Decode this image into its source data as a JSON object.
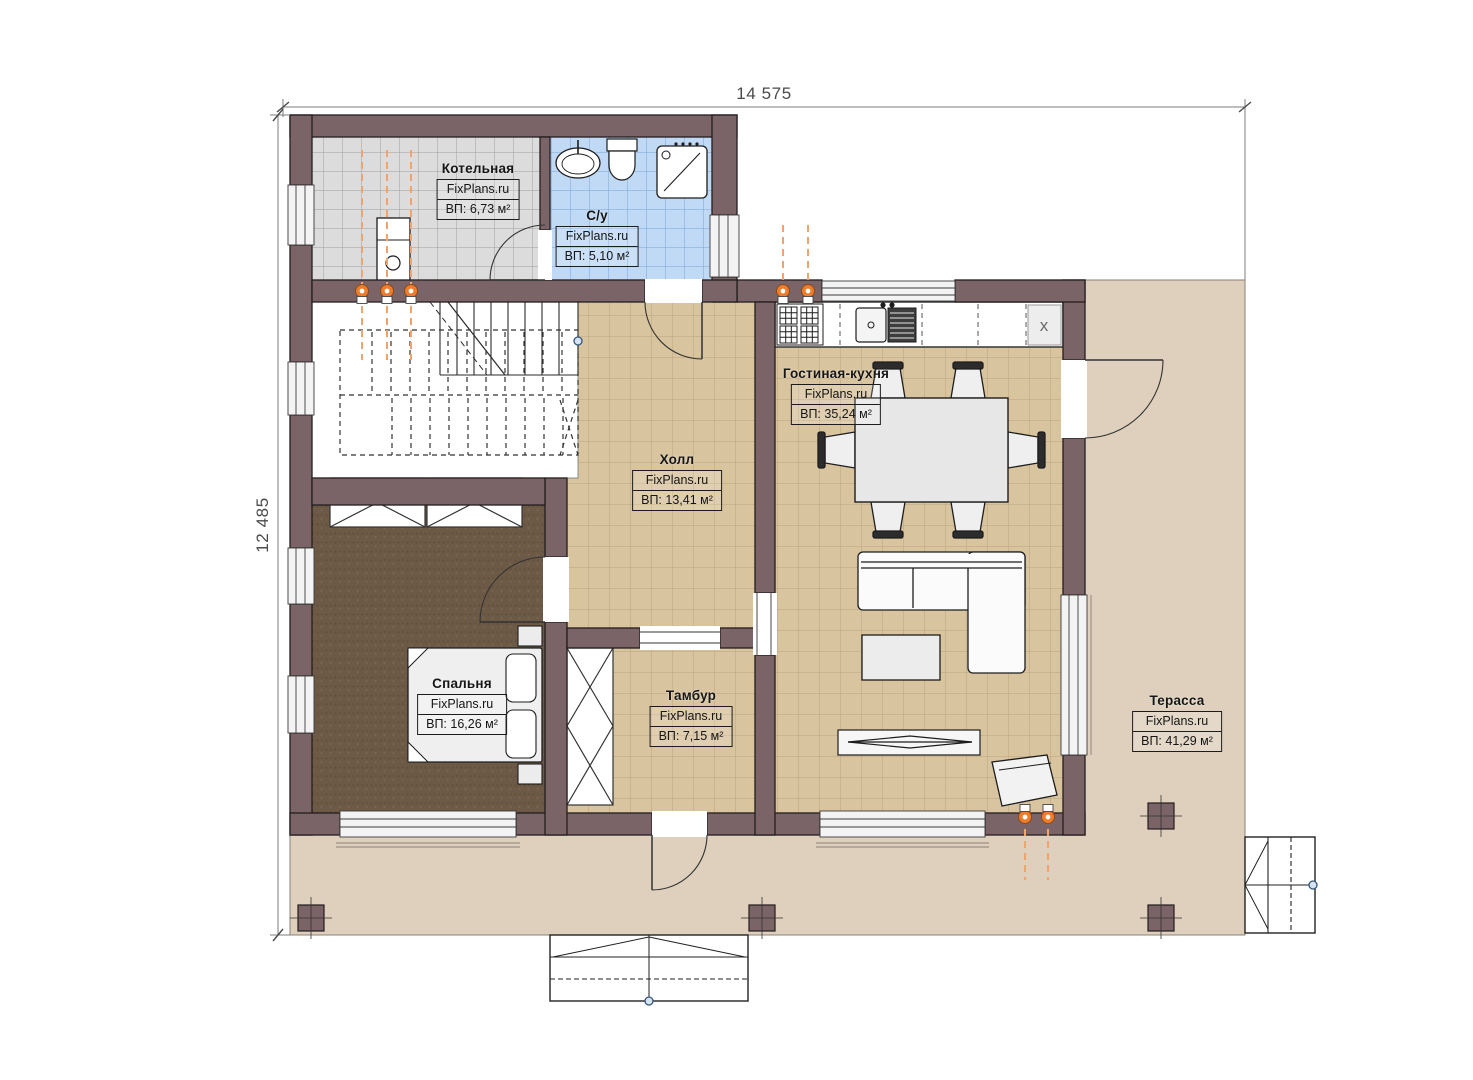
{
  "plan": {
    "dimensions": {
      "width": "14 575",
      "height": "12 485"
    },
    "watermark": "FixPlans.ru",
    "rooms": [
      {
        "name": "Котельная",
        "area": "ВП: 6,73 м²"
      },
      {
        "name": "С/у",
        "area": "ВП: 5,10 м²"
      },
      {
        "name": "Холл",
        "area": "ВП: 13,41 м²"
      },
      {
        "name": "Гостиная-кухня",
        "area": "ВП: 35,24 м²"
      },
      {
        "name": "Спальня",
        "area": "ВП: 16,26 м²"
      },
      {
        "name": "Тамбур",
        "area": "ВП: 7,15 м²"
      },
      {
        "name": "Терасса",
        "area": "ВП: 41,29 м²"
      }
    ],
    "kitchen": {
      "fridge_symbol": "x"
    },
    "colors": {
      "wall": "#7a6467",
      "tile_tan": "#d8c49e",
      "tile_blue": "#c0d9f4",
      "tile_gray": "#dcdcdc",
      "carpet_brown": "#6d5a46",
      "terrace": "#ded0bc",
      "accent_orange": "#ed7d2b"
    }
  }
}
